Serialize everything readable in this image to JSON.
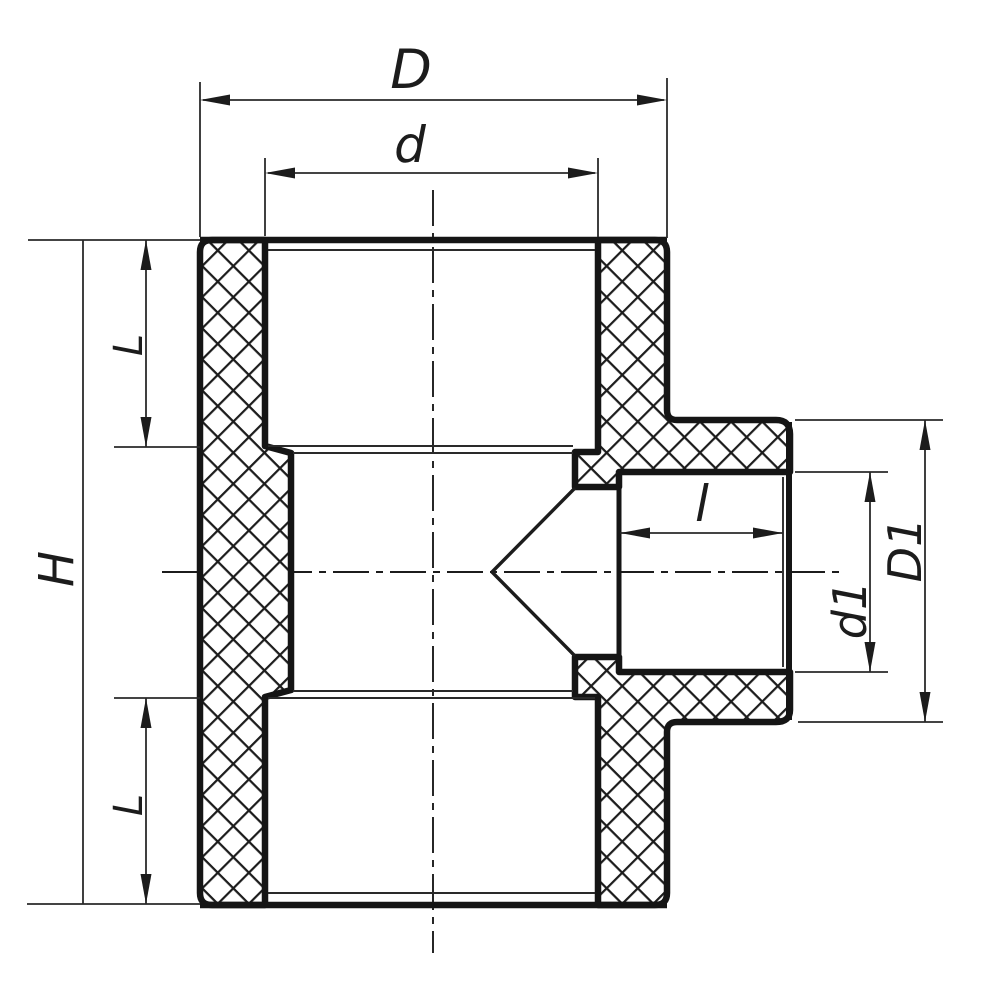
{
  "drawing": {
    "title": "Reducing tee pipe fitting cross-section",
    "labels": {
      "overall_width": "D",
      "socket_inner_diameter": "d",
      "overall_height": "H",
      "socket_length_top": "L",
      "socket_length_bottom": "L",
      "branch_socket_length": "l",
      "branch_inner_diameter": "d1",
      "branch_outer_diameter": "D1"
    },
    "colors": {
      "line": "#1c1c1c",
      "background": "#ffffff"
    }
  }
}
